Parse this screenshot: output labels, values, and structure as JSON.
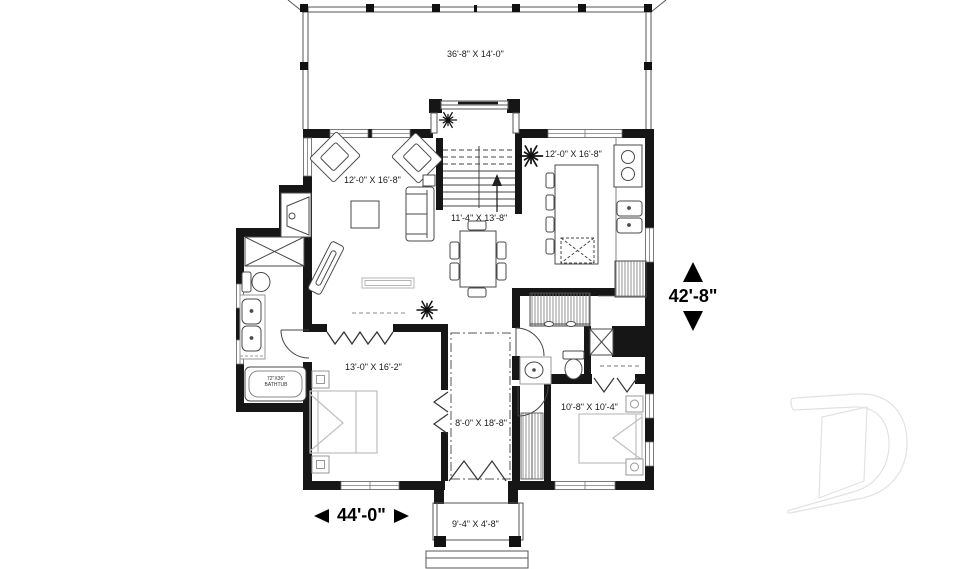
{
  "plan": {
    "title": "First floor plan",
    "deck": {
      "label": "36'-8\" X 14'-0\""
    },
    "living_room": {
      "label": "12'-0\" X 16'-8\""
    },
    "kitchen": {
      "label": "12'-0\" X 16'-8\""
    },
    "dining": {
      "label": "11'-4\" X 13'-8\""
    },
    "master_bedroom": {
      "label": "13'-0\" X 16'-2\""
    },
    "hall": {
      "label": "8'-0\" X 18'-8\""
    },
    "bedroom2": {
      "label": "10'-8\" X 10'-4\""
    },
    "porch": {
      "label": "9'-4\" X 4'-8\""
    },
    "bathtub": {
      "line1": "72\"X36\"",
      "line2": "BATHTUB"
    },
    "dimensions": {
      "width": "44'-0\"",
      "height": "42'-8\""
    },
    "icons": [
      "ceiling-light-burst",
      "stair-up-arrow",
      "drummond-d-watermark"
    ],
    "colors": {
      "background": "#ffffff",
      "wall": "#161616",
      "furniture_line": "#4a4a4a",
      "light_furniture_line": "#bdbdbd",
      "text": "#1a1a1a",
      "watermark": "#e4e4e4"
    }
  }
}
